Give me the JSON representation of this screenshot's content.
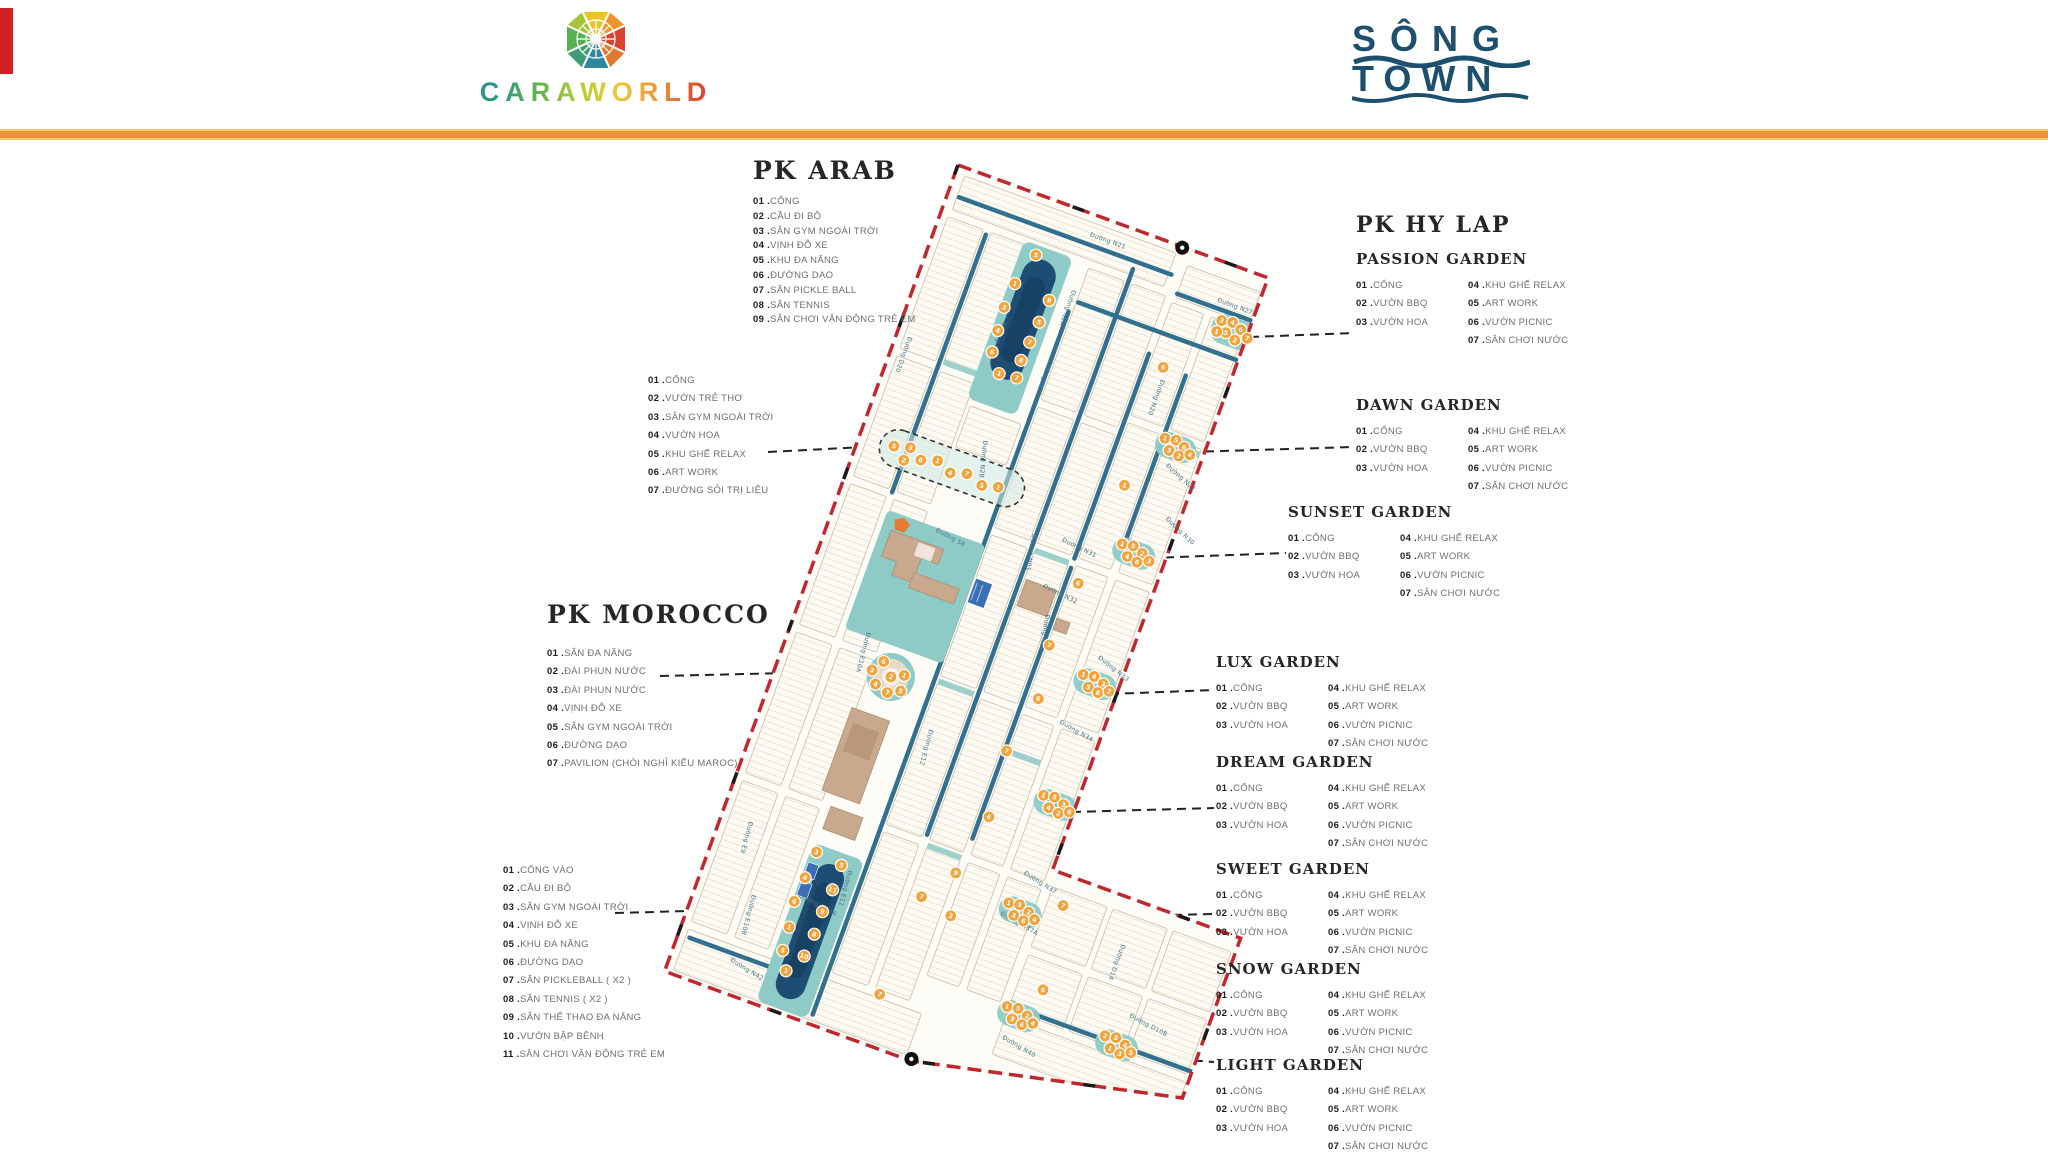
{
  "header": {
    "brand": "CARAWORLD",
    "song": "SÔNG",
    "town": "TOWN"
  },
  "pk_arab": {
    "title": "PK ARAB",
    "items": [
      {
        "num": "01",
        "label": "CỔNG"
      },
      {
        "num": "02",
        "label": "CẦU ĐI BỘ"
      },
      {
        "num": "03",
        "label": "SÂN GYM NGOÀI TRỜI"
      },
      {
        "num": "04",
        "label": "VỊNH ĐỖ XE"
      },
      {
        "num": "05",
        "label": "KHU ĐA NĂNG"
      },
      {
        "num": "06",
        "label": "ĐƯỜNG DẠO"
      },
      {
        "num": "07",
        "label": "SÂN PICKLE BALL"
      },
      {
        "num": "08",
        "label": "SÂN TENNIS"
      },
      {
        "num": "09",
        "label": "SÂN CHƠI VẬN ĐỘNG TRẺ EM"
      }
    ]
  },
  "arab_garden": {
    "items": [
      {
        "num": "01",
        "label": "CỔNG"
      },
      {
        "num": "02",
        "label": "VƯỜN TRẺ THƠ"
      },
      {
        "num": "03",
        "label": "SÂN GYM NGOÀI TRỜI"
      },
      {
        "num": "04",
        "label": "VƯỜN HOA"
      },
      {
        "num": "05",
        "label": "KHU GHẾ RELAX"
      },
      {
        "num": "06",
        "label": "ART WORK"
      },
      {
        "num": "07",
        "label": "ĐƯỜNG SỎI TRỊ LIỆU"
      }
    ]
  },
  "pk_hy_lap": {
    "title": "PK HY LAP"
  },
  "garden_items_left": [
    {
      "num": "01",
      "label": "CỔNG"
    },
    {
      "num": "02",
      "label": "VƯỜN BBQ"
    },
    {
      "num": "03",
      "label": "VƯỜN HOA"
    }
  ],
  "garden_items_right": [
    {
      "num": "04",
      "label": "KHU GHẾ RELAX"
    },
    {
      "num": "05",
      "label": "ART WORK"
    },
    {
      "num": "06",
      "label": "VƯỜN PICNIC"
    },
    {
      "num": "07",
      "label": "SÂN CHƠI NƯỚC"
    }
  ],
  "gardens": [
    {
      "name": "PASSION GARDEN"
    },
    {
      "name": "DAWN GARDEN"
    },
    {
      "name": "SUNSET GARDEN"
    },
    {
      "name": "LUX GARDEN"
    },
    {
      "name": "DREAM GARDEN"
    },
    {
      "name": "SWEET GARDEN"
    },
    {
      "name": "SNOW GARDEN"
    },
    {
      "name": "LIGHT GARDEN"
    }
  ],
  "pk_morocco": {
    "title": "PK MOROCCO",
    "items": [
      {
        "num": "01",
        "label": "SÂN ĐA NĂNG"
      },
      {
        "num": "02",
        "label": "ĐÀI PHUN NƯỚC"
      },
      {
        "num": "03",
        "label": "ĐÀI PHUN NƯỚC"
      },
      {
        "num": "04",
        "label": "VỊNH ĐỖ XE"
      },
      {
        "num": "05",
        "label": "SÂN GYM NGOÀI TRỜI"
      },
      {
        "num": "06",
        "label": "ĐƯỜNG DẠO"
      },
      {
        "num": "07",
        "label": "PAVILION (CHÒI NGHỈ KIỂU MAROC)"
      }
    ]
  },
  "morocco_south": {
    "items": [
      {
        "num": "01",
        "label": "CỔNG VÀO"
      },
      {
        "num": "02",
        "label": "CẦU ĐI BỘ"
      },
      {
        "num": "03",
        "label": "SÂN GYM NGOÀI TRỜI"
      },
      {
        "num": "04",
        "label": "VỊNH ĐỖ XE"
      },
      {
        "num": "05",
        "label": "KHU ĐA NĂNG"
      },
      {
        "num": "06",
        "label": "ĐƯỜNG DẠO"
      },
      {
        "num": "07",
        "label": "SÂN PICKLEBALL ( X2 )"
      },
      {
        "num": "08",
        "label": "SÂN TENNIS ( X2 )"
      },
      {
        "num": "09",
        "label": "SÂN THỂ THAO ĐA NĂNG"
      },
      {
        "num": "10",
        "label": "VƯỜN BẬP BÊNH"
      },
      {
        "num": "11",
        "label": "SÂN CHƠI VẬN ĐỘNG TRẺ EM"
      }
    ]
  },
  "map": {
    "colors": {
      "boundary": "#c1272d",
      "road": "#31708f",
      "park": "#8ecbc6",
      "lake": "#1e4d74",
      "lake_dark": "#163d5e",
      "lot": "#fcfaf2",
      "lot_line": "#ddd2ba",
      "lot_stroke": "#c9bda6",
      "marker": "#f2a33c",
      "building": "#c8a98e",
      "pool": "#3a6fb5",
      "plaza": "#ead9c4",
      "label": "#45748a",
      "pentagon": "#e8792f"
    },
    "street_labels": [
      {
        "t": "Đường N21",
        "x": 148,
        "y": 22,
        "r": 0
      },
      {
        "t": "Đường N2A",
        "x": 150,
        "y": 78,
        "r": 90
      },
      {
        "t": "Đường N2C",
        "x": 96,
        "y": 132,
        "r": 90
      },
      {
        "t": "Đường N2B",
        "x": 152,
        "y": 152,
        "r": 90
      },
      {
        "t": "Đường N2B.1",
        "x": 118,
        "y": 250,
        "r": 76
      },
      {
        "t": "Đường D20",
        "x": 12,
        "y": 178,
        "r": 90
      },
      {
        "t": "Đường N27",
        "x": 290,
        "y": 40,
        "r": 0
      },
      {
        "t": "Đường N20",
        "x": 264,
        "y": 132,
        "r": 90
      },
      {
        "t": "Đường N22",
        "x": 298,
        "y": 212,
        "r": 22
      },
      {
        "t": "Đường N30",
        "x": 316,
        "y": 262,
        "r": 24
      },
      {
        "t": "Đường N31",
        "x": 226,
        "y": 318,
        "r": 6
      },
      {
        "t": "Đường N32",
        "x": 224,
        "y": 368,
        "r": 6
      },
      {
        "t": "Đường N33",
        "x": 300,
        "y": 416,
        "r": 18
      },
      {
        "t": "Đường N34",
        "x": 286,
        "y": 490,
        "r": 10
      },
      {
        "t": "Đường N36",
        "x": 296,
        "y": 566,
        "r": 14
      },
      {
        "t": "Đường N37",
        "x": 304,
        "y": 644,
        "r": 12
      },
      {
        "t": "Đường N37A",
        "x": 296,
        "y": 690,
        "r": 10
      },
      {
        "t": "Đường N40",
        "x": 340,
        "y": 806,
        "r": 10
      },
      {
        "t": "Đường N40A",
        "x": 100,
        "y": 742,
        "r": 8
      },
      {
        "t": "Đường N42",
        "x": 58,
        "y": 826,
        "r": 12
      },
      {
        "t": "Đường D14",
        "x": 420,
        "y": 676,
        "r": 90
      },
      {
        "t": "Đường D10B",
        "x": 452,
        "y": 742,
        "r": 8
      },
      {
        "t": "Đường S8",
        "x": 104,
        "y": 352,
        "r": 8
      },
      {
        "t": "Đường E9",
        "x": 28,
        "y": 688,
        "r": 85
      },
      {
        "t": "Đường E10A",
        "x": 74,
        "y": 470,
        "r": 85
      },
      {
        "t": "Đường E10B",
        "x": 56,
        "y": 756,
        "r": 85
      },
      {
        "t": "Đường E11",
        "x": 138,
        "y": 700,
        "r": 85
      },
      {
        "t": "Đường E12",
        "x": 166,
        "y": 540,
        "r": 85
      },
      {
        "t": "Đường N01",
        "x": 196,
        "y": 321,
        "r": 80
      },
      {
        "t": "Đường N02",
        "x": 236,
        "y": 392,
        "r": 80
      }
    ],
    "marker_clusters": [
      {
        "name": "arab-lake-markers",
        "markers": [
          [
            104,
            58,
            "5"
          ],
          [
            94,
            92,
            "1"
          ],
          [
            132,
            96,
            "9"
          ],
          [
            92,
            118,
            "3"
          ],
          [
            130,
            120,
            "5"
          ],
          [
            94,
            142,
            "4"
          ],
          [
            128,
            142,
            "7"
          ],
          [
            96,
            164,
            "6"
          ],
          [
            126,
            162,
            "8"
          ],
          [
            110,
            182,
            "1"
          ],
          [
            128,
            180,
            "7"
          ]
        ]
      },
      {
        "name": "arab-garden-row-markers",
        "markers": [
          [
            36,
            286,
            "5"
          ],
          [
            52,
            282,
            "3"
          ],
          [
            50,
            296,
            "2"
          ],
          [
            66,
            290,
            "6"
          ],
          [
            82,
            285,
            "1"
          ],
          [
            98,
            292,
            "4"
          ],
          [
            114,
            287,
            "7"
          ],
          [
            132,
            293,
            "5"
          ],
          [
            148,
            289,
            "1"
          ]
        ]
      },
      {
        "name": "passion-garden-markers",
        "markers": [
          [
            301,
            56,
            "3"
          ],
          [
            312,
            54,
            "4"
          ],
          [
            309,
            66,
            "5"
          ],
          [
            300,
            68,
            "1"
          ],
          [
            322,
            58,
            "6"
          ],
          [
            320,
            70,
            "2"
          ],
          [
            331,
            64,
            "7"
          ]
        ]
      },
      {
        "name": "dawn-garden-markers",
        "markers": [
          [
            288,
            186,
            "1"
          ],
          [
            299,
            184,
            "5"
          ],
          [
            296,
            196,
            "3"
          ],
          [
            309,
            188,
            "6"
          ],
          [
            307,
            198,
            "2"
          ],
          [
            317,
            193,
            "4"
          ]
        ]
      },
      {
        "name": "sunset-garden-markers",
        "markers": [
          [
            284,
            300,
            "1"
          ],
          [
            295,
            298,
            "5"
          ],
          [
            293,
            310,
            "4"
          ],
          [
            306,
            302,
            "2"
          ],
          [
            304,
            312,
            "6"
          ],
          [
            315,
            307,
            "3"
          ]
        ]
      },
      {
        "name": "lux-garden-markers",
        "markers": [
          [
            292,
            436,
            "1"
          ],
          [
            303,
            434,
            "4"
          ],
          [
            301,
            446,
            "5"
          ],
          [
            314,
            438,
            "3"
          ],
          [
            312,
            448,
            "6"
          ],
          [
            322,
            443,
            "2"
          ]
        ]
      },
      {
        "name": "dream-garden-markers",
        "markers": [
          [
            296,
            563,
            "1"
          ],
          [
            307,
            561,
            "5"
          ],
          [
            305,
            573,
            "4"
          ],
          [
            318,
            565,
            "3"
          ],
          [
            316,
            575,
            "2"
          ],
          [
            326,
            570,
            "6"
          ]
        ]
      },
      {
        "name": "sweet-garden-markers",
        "markers": [
          [
            300,
            676,
            "1"
          ],
          [
            311,
            674,
            "5"
          ],
          [
            309,
            686,
            "3"
          ],
          [
            322,
            678,
            "2"
          ],
          [
            320,
            688,
            "6"
          ],
          [
            330,
            683,
            "4"
          ]
        ]
      },
      {
        "name": "snow-garden-markers",
        "markers": [
          [
            334,
            774,
            "1"
          ],
          [
            345,
            772,
            "5"
          ],
          [
            343,
            784,
            "3"
          ],
          [
            356,
            776,
            "2"
          ],
          [
            354,
            786,
            "6"
          ],
          [
            364,
            781,
            "4"
          ]
        ]
      },
      {
        "name": "light-garden-markers",
        "markers": [
          [
            436,
            768,
            "2"
          ],
          [
            447,
            766,
            "5"
          ],
          [
            445,
            778,
            "1"
          ],
          [
            458,
            770,
            "4"
          ],
          [
            456,
            780,
            "3"
          ],
          [
            466,
            775,
            "5"
          ]
        ]
      },
      {
        "name": "morocco-plaza-markers",
        "markers": [
          [
            100,
            492,
            "6"
          ],
          [
            112,
            504,
            "2"
          ],
          [
            124,
            498,
            "1"
          ],
          [
            100,
            516,
            "4"
          ],
          [
            114,
            520,
            "7"
          ],
          [
            126,
            514,
            "5"
          ],
          [
            92,
            504,
            "3"
          ]
        ]
      },
      {
        "name": "morocco-lake-markers",
        "markers": [
          [
            102,
            694,
            "3"
          ],
          [
            130,
            698,
            "5"
          ],
          [
            100,
            722,
            "4"
          ],
          [
            130,
            724,
            "11"
          ],
          [
            98,
            748,
            "6"
          ],
          [
            128,
            748,
            "9"
          ],
          [
            102,
            774,
            "1"
          ],
          [
            128,
            772,
            "8"
          ],
          [
            104,
            798,
            "5"
          ],
          [
            126,
            796,
            "10"
          ],
          [
            114,
            816,
            "1"
          ]
        ]
      },
      {
        "name": "street-single-markers",
        "markers": [
          [
            262,
            120,
            "6"
          ],
          [
            266,
            244,
            "1"
          ],
          [
            256,
            352,
            "6"
          ],
          [
            250,
            420,
            "7"
          ],
          [
            258,
            474,
            "6"
          ],
          [
            246,
            534,
            "7"
          ],
          [
            252,
            602,
            "6"
          ],
          [
            240,
            666,
            "9"
          ],
          [
            250,
            708,
            "3"
          ],
          [
            352,
            660,
            "7"
          ],
          [
            362,
            746,
            "6"
          ],
          [
            216,
            700,
            "7"
          ],
          [
            210,
            806,
            "7"
          ]
        ]
      }
    ]
  }
}
